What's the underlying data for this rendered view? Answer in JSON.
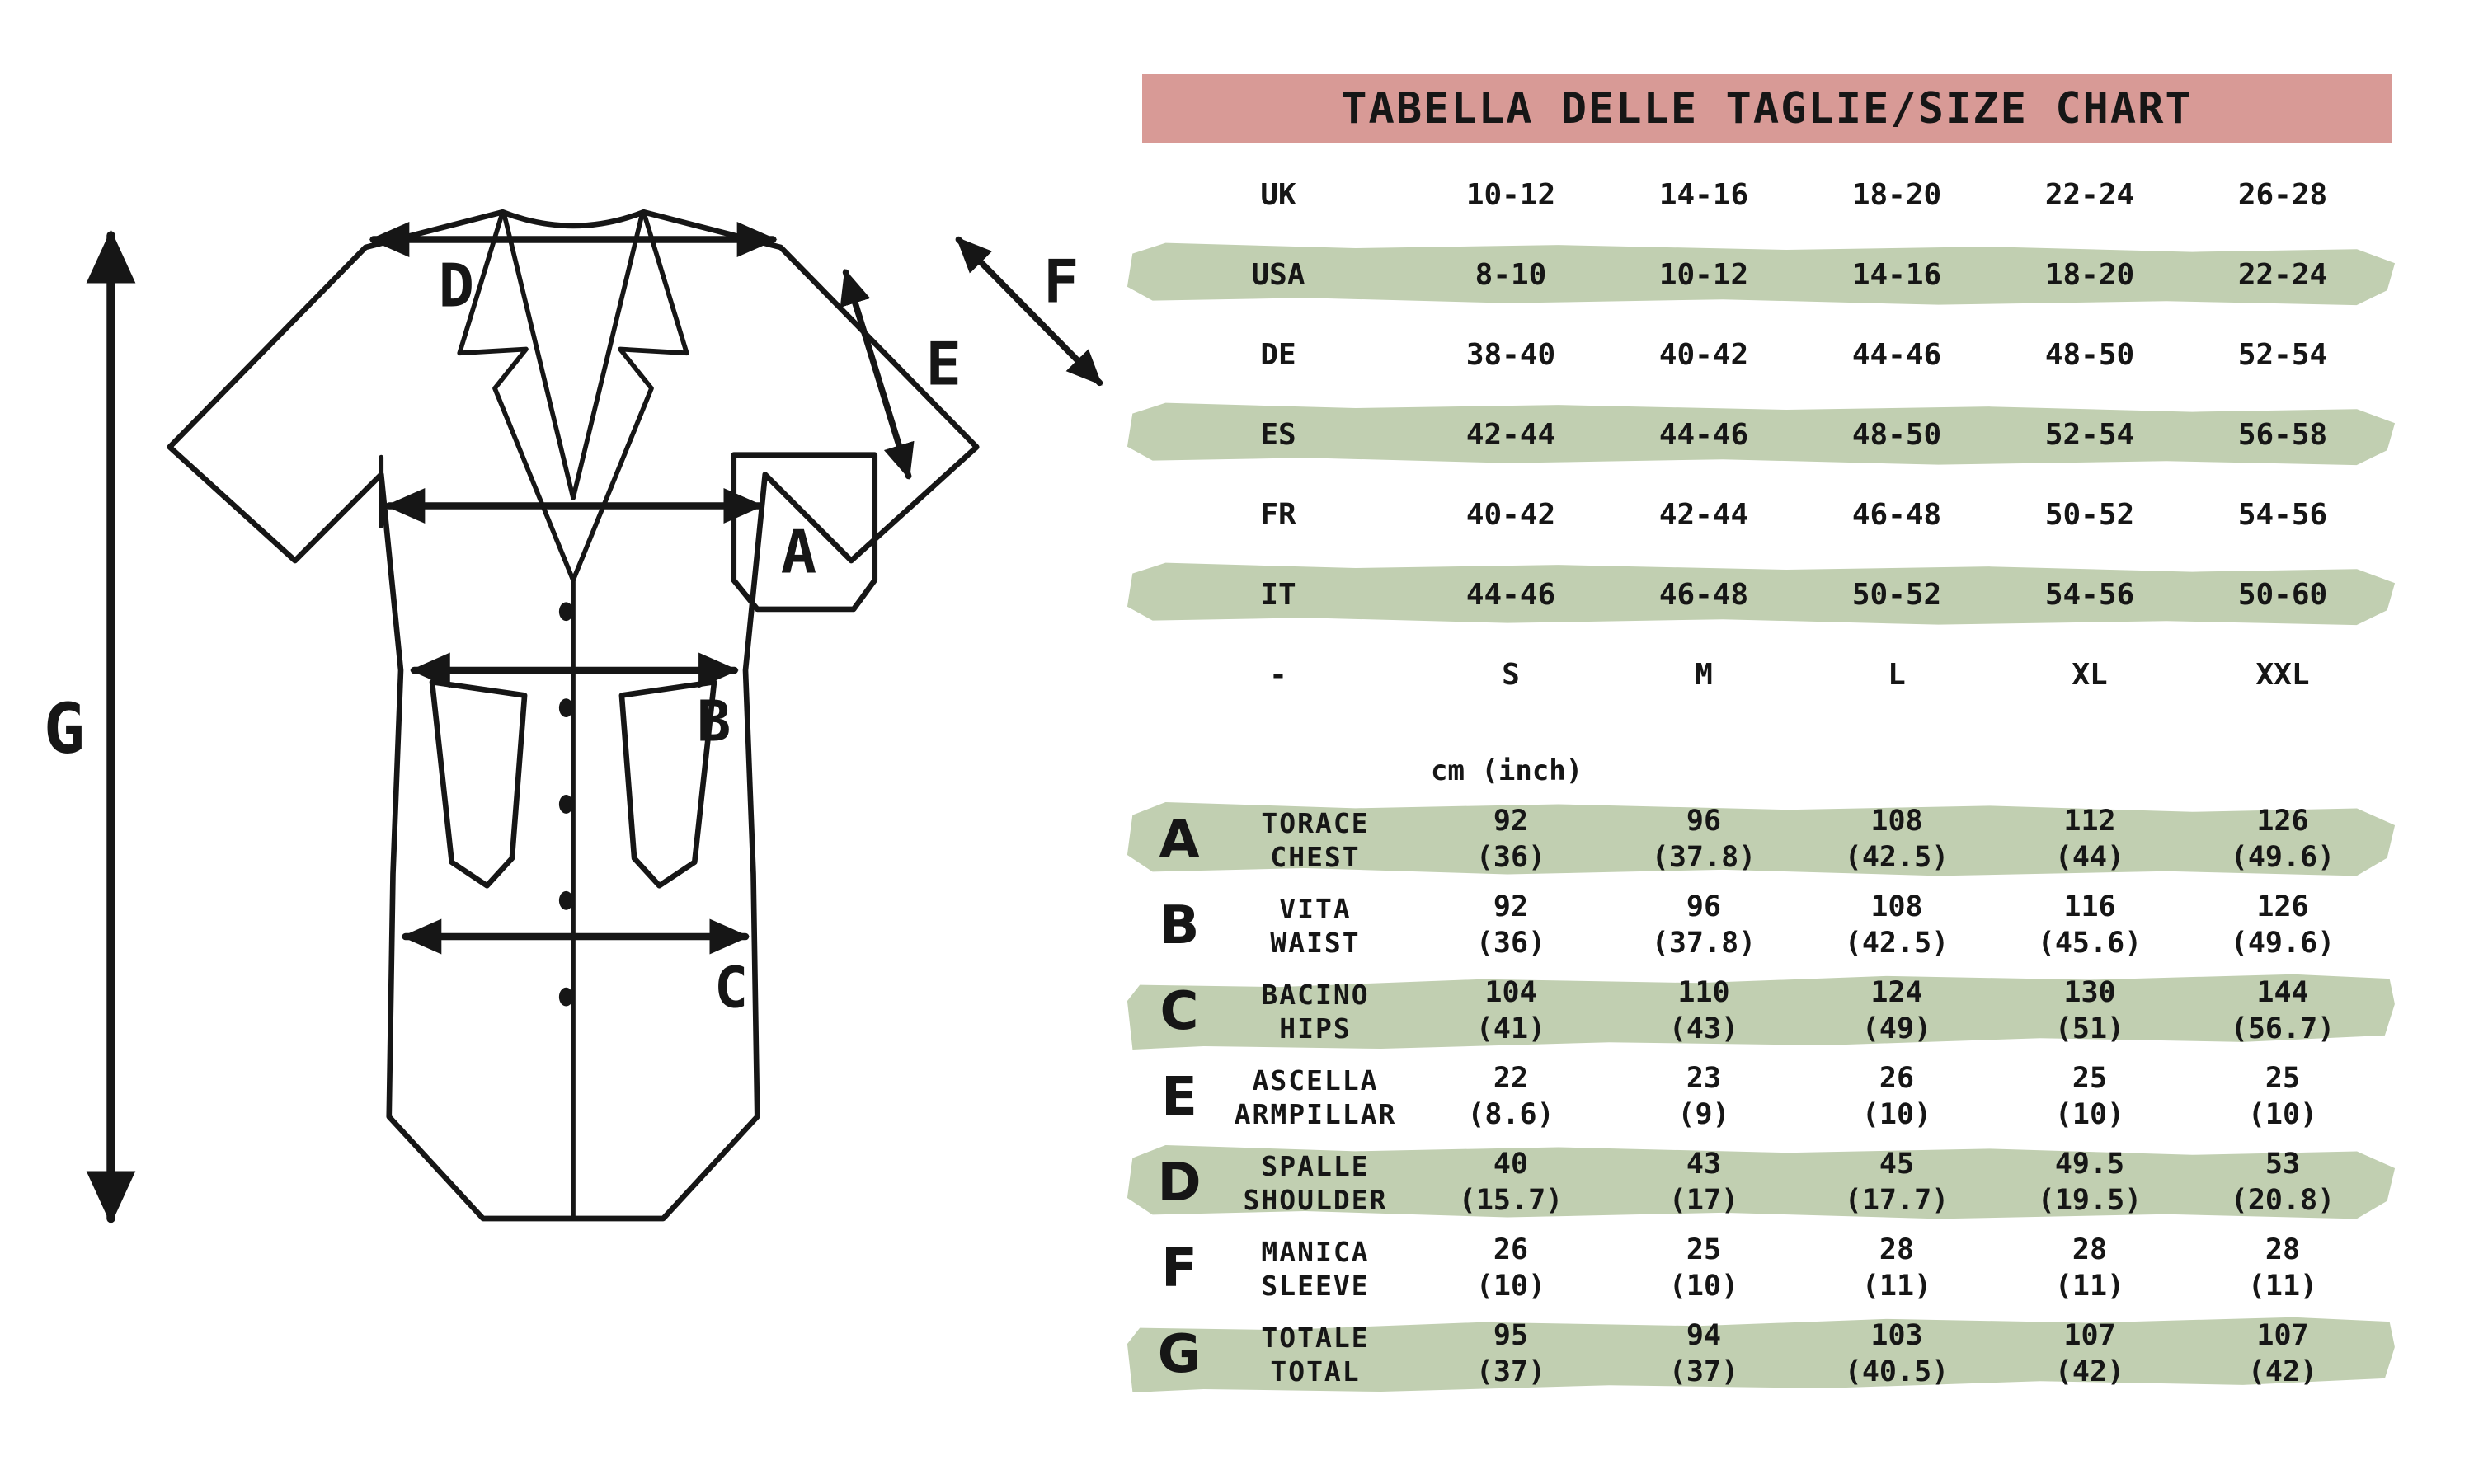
{
  "title": "TABELLA DELLE TAGLIE/SIZE CHART",
  "units_note": "cm (inch)",
  "colors": {
    "pink": "#D89A96",
    "green": "#C1CFB1",
    "ink": "#161616"
  },
  "size_table": {
    "rows": [
      {
        "label": "UK",
        "band": false,
        "values": [
          "10-12",
          "14-16",
          "18-20",
          "22-24",
          "26-28"
        ]
      },
      {
        "label": "USA",
        "band": true,
        "values": [
          "8-10",
          "10-12",
          "14-16",
          "18-20",
          "22-24"
        ]
      },
      {
        "label": "DE",
        "band": false,
        "values": [
          "38-40",
          "40-42",
          "44-46",
          "48-50",
          "52-54"
        ]
      },
      {
        "label": "ES",
        "band": true,
        "values": [
          "42-44",
          "44-46",
          "48-50",
          "52-54",
          "56-58"
        ]
      },
      {
        "label": "FR",
        "band": false,
        "values": [
          "40-42",
          "42-44",
          "46-48",
          "50-52",
          "54-56"
        ]
      },
      {
        "label": "IT",
        "band": true,
        "values": [
          "44-46",
          "46-48",
          "50-52",
          "54-56",
          "50-60"
        ]
      },
      {
        "label": "-",
        "band": false,
        "values": [
          "S",
          "M",
          "L",
          "XL",
          "XXL"
        ]
      }
    ]
  },
  "measure_table": {
    "rows": [
      {
        "key": "A",
        "label_it": "TORACE",
        "label_en": "CHEST",
        "band": true,
        "cm": [
          "92",
          "96",
          "108",
          "112",
          "126"
        ],
        "inch": [
          "(36)",
          "(37.8)",
          "(42.5)",
          "(44)",
          "(49.6)"
        ]
      },
      {
        "key": "B",
        "label_it": "VITA",
        "label_en": "WAIST",
        "band": false,
        "cm": [
          "92",
          "96",
          "108",
          "116",
          "126"
        ],
        "inch": [
          "(36)",
          "(37.8)",
          "(42.5)",
          "(45.6)",
          "(49.6)"
        ]
      },
      {
        "key": "C",
        "label_it": "BACINO",
        "label_en": "HIPS",
        "band": true,
        "cm": [
          "104",
          "110",
          "124",
          "130",
          "144"
        ],
        "inch": [
          "(41)",
          "(43)",
          "(49)",
          "(51)",
          "(56.7)"
        ]
      },
      {
        "key": "E",
        "label_it": "ASCELLA",
        "label_en": "ARMPILLAR",
        "band": false,
        "cm": [
          "22",
          "23",
          "26",
          "25",
          "25"
        ],
        "inch": [
          "(8.6)",
          "(9)",
          "(10)",
          "(10)",
          "(10)"
        ]
      },
      {
        "key": "D",
        "label_it": "SPALLE",
        "label_en": "SHOULDER",
        "band": true,
        "cm": [
          "40",
          "43",
          "45",
          "49.5",
          "53"
        ],
        "inch": [
          "(15.7)",
          "(17)",
          "(17.7)",
          "(19.5)",
          "(20.8)"
        ]
      },
      {
        "key": "F",
        "label_it": "MANICA",
        "label_en": "SLEEVE",
        "band": false,
        "cm": [
          "26",
          "25",
          "28",
          "28",
          "28"
        ],
        "inch": [
          "(10)",
          "(10)",
          "(11)",
          "(11)",
          "(11)"
        ]
      },
      {
        "key": "G",
        "label_it": "TOTALE",
        "label_en": "TOTAL",
        "band": true,
        "cm": [
          "95",
          "94",
          "103",
          "107",
          "107"
        ],
        "inch": [
          "(37)",
          "(37)",
          "(40.5)",
          "(42)",
          "(42)"
        ]
      }
    ]
  },
  "diagram": {
    "labels": {
      "A": "A",
      "B": "B",
      "C": "C",
      "D": "D",
      "E": "E",
      "F": "F",
      "G": "G"
    }
  }
}
